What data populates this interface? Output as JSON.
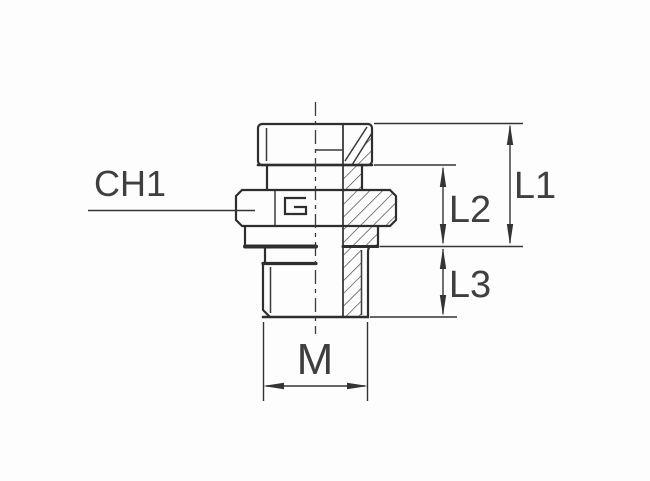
{
  "drawing": {
    "kind": "technical-dimension-drawing",
    "background_color": "#fdfdfd",
    "line_color": "#343434",
    "text_color": "#3f3f3f",
    "labels": {
      "ch1": "CH1",
      "l1": "L1",
      "l2": "L2",
      "l3": "L3",
      "m": "M"
    },
    "icons": {
      "hex_stamp": "square-g-mark"
    }
  }
}
